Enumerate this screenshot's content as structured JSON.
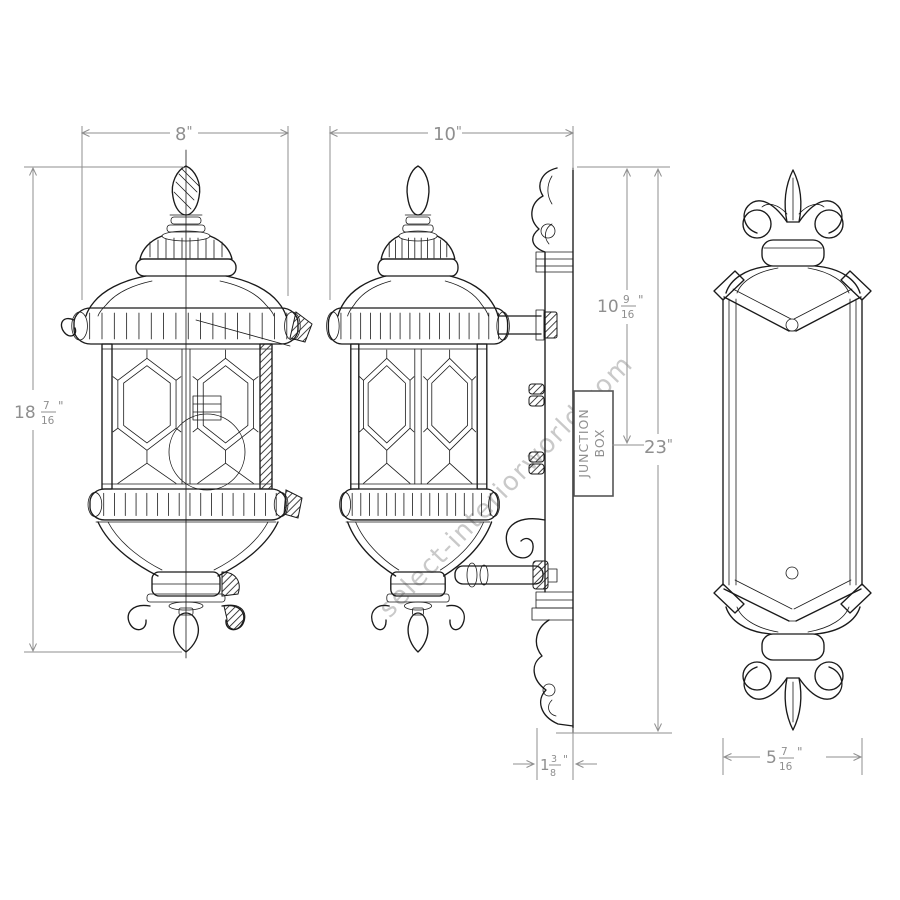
{
  "watermark": "select-interiorworld.com",
  "junction_box": {
    "line1": "JUNCTION",
    "line2": "BOX"
  },
  "dimensions": {
    "front_width": {
      "value": "8",
      "unit": "\""
    },
    "front_height": {
      "whole": "18",
      "numerator": "7",
      "denominator": "16",
      "unit": "\""
    },
    "side_width": {
      "value": "10",
      "unit": "\""
    },
    "top_to_junction": {
      "whole": "10",
      "numerator": "9",
      "denominator": "16",
      "unit": "\""
    },
    "overall_height": {
      "value": "23",
      "unit": "\""
    },
    "wall_depth": {
      "whole": "1",
      "numerator": "3",
      "denominator": "8",
      "unit": "\""
    },
    "backplate_width": {
      "whole": "5",
      "numerator": "7",
      "denominator": "16",
      "unit": "\""
    }
  },
  "colors": {
    "line": "#1a1a1a",
    "dimension": "#8f8f8f",
    "watermark": "#c9c9c9"
  }
}
